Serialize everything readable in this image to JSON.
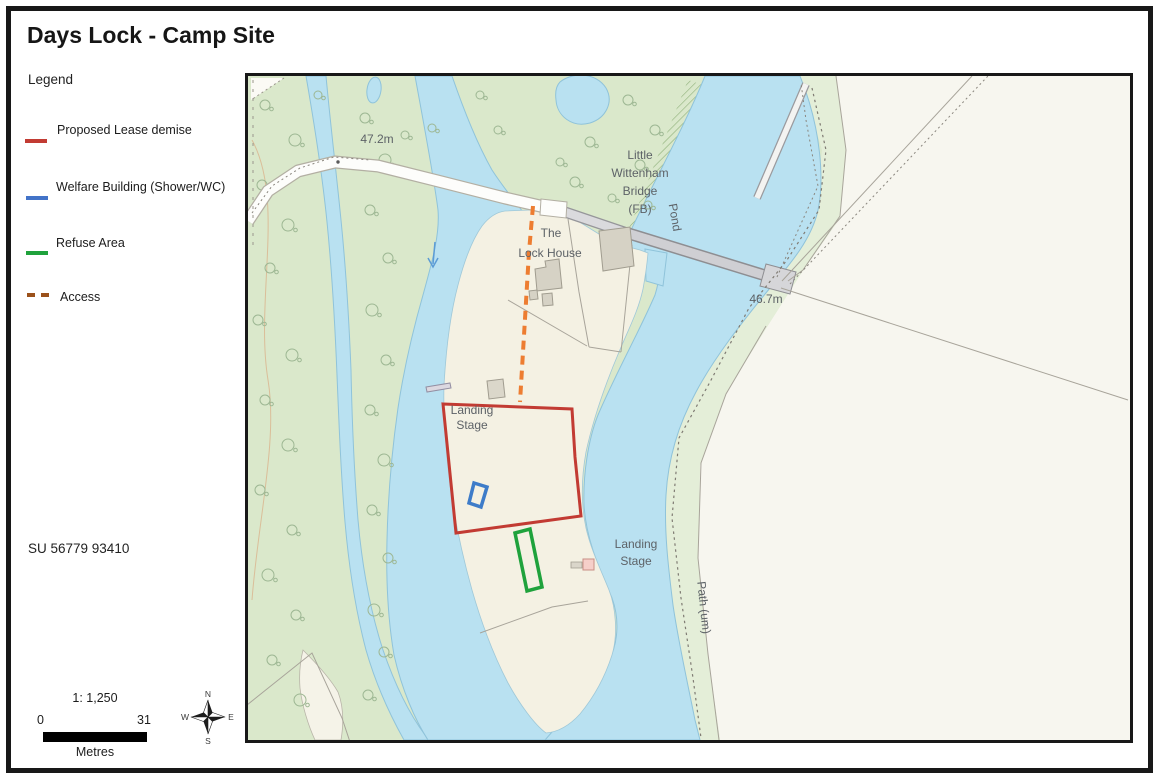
{
  "title": "Days Lock - Camp Site",
  "legend": {
    "heading": "Legend",
    "items": [
      {
        "label": "Proposed Lease demise",
        "color": "#c23b33",
        "line_style": "solid"
      },
      {
        "label": "Welfare Building (Shower/WC)",
        "color": "#4273c8",
        "line_style": "solid"
      },
      {
        "label": "Refuse Area",
        "color": "#1fa23c",
        "line_style": "solid"
      },
      {
        "label": "Access",
        "color": "#9b511b",
        "line_style": "dashed"
      }
    ]
  },
  "grid_reference": "SU 56779 93410",
  "scale_bar": {
    "ratio": "1: 1,250",
    "start": "0",
    "end": "31",
    "units": "Metres"
  },
  "compass": {
    "north": "N",
    "east": "E",
    "south": "S",
    "west": "W"
  },
  "map_labels": {
    "spot_height_1": "47.2m",
    "bridge_line1": "Little",
    "bridge_line2": "Wittenham",
    "bridge_line3": "Bridge",
    "bridge_line4": "(FB)",
    "pond": "Pond",
    "lock_house_line1": "The",
    "lock_house_line2": "Lock House",
    "spot_height_2": "46.7m",
    "landing_stage_1_line1": "Landing",
    "landing_stage_1_line2": "Stage",
    "landing_stage_2_line1": "Landing",
    "landing_stage_2_line2": "Stage",
    "path": "Path (um)"
  },
  "map_overlay_colors": {
    "lease": "#c23b33",
    "welfare": "#3d7cc9",
    "refuse": "#1fa23c",
    "access": "#ed7d31"
  }
}
